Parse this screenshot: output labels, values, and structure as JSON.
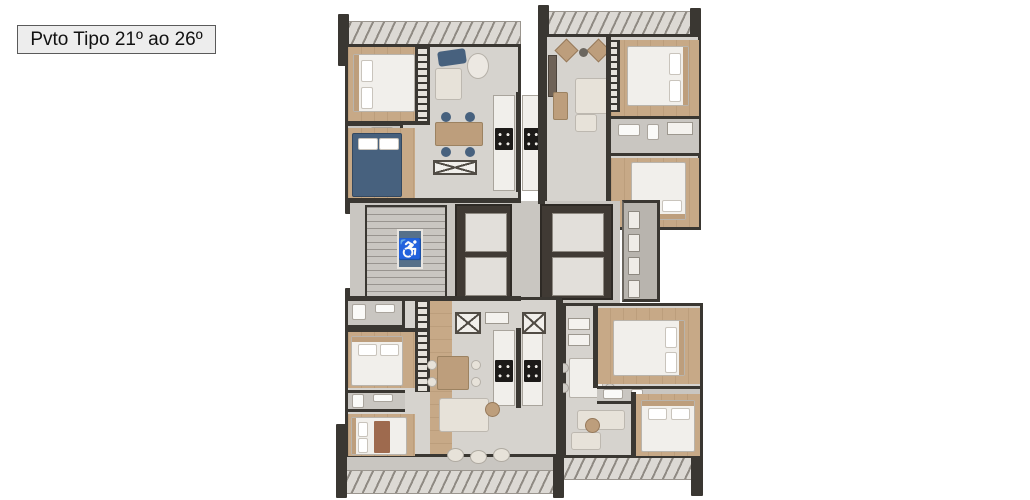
{
  "label": {
    "text": "Pvto Tipo 21º ao 26º"
  },
  "icons": {
    "wheelchair_glyph": "♿",
    "wheelchair_name": "wheelchair-accessibility-icon"
  },
  "colors": {
    "page_bg": "#ffffff",
    "label_bg": "#ededed",
    "label_border": "#5a5a5a",
    "wall": "#3a3732",
    "floor_tile": "#d6d3ce",
    "floor_tile_dark": "#c9c6c1",
    "wood_floor": "#c7a987",
    "balcony": "#dcd9d4",
    "rail_tick": "#8f8a83",
    "furniture_white": "#f1efeb",
    "furniture_cream": "#e7e2d9",
    "furniture_wood": "#bd9e7c",
    "blue_accent": "#47617e",
    "sign_blue": "#56708a",
    "elevator_dark": "#403a34",
    "elevator_cab": "#e2dfda",
    "stove_black": "#1c1a18"
  },
  "plan": {
    "description": "Typical floor plan, floors 21 to 26: four apartment units around a central core with stairs, four elevators and AC technical balcony"
  }
}
